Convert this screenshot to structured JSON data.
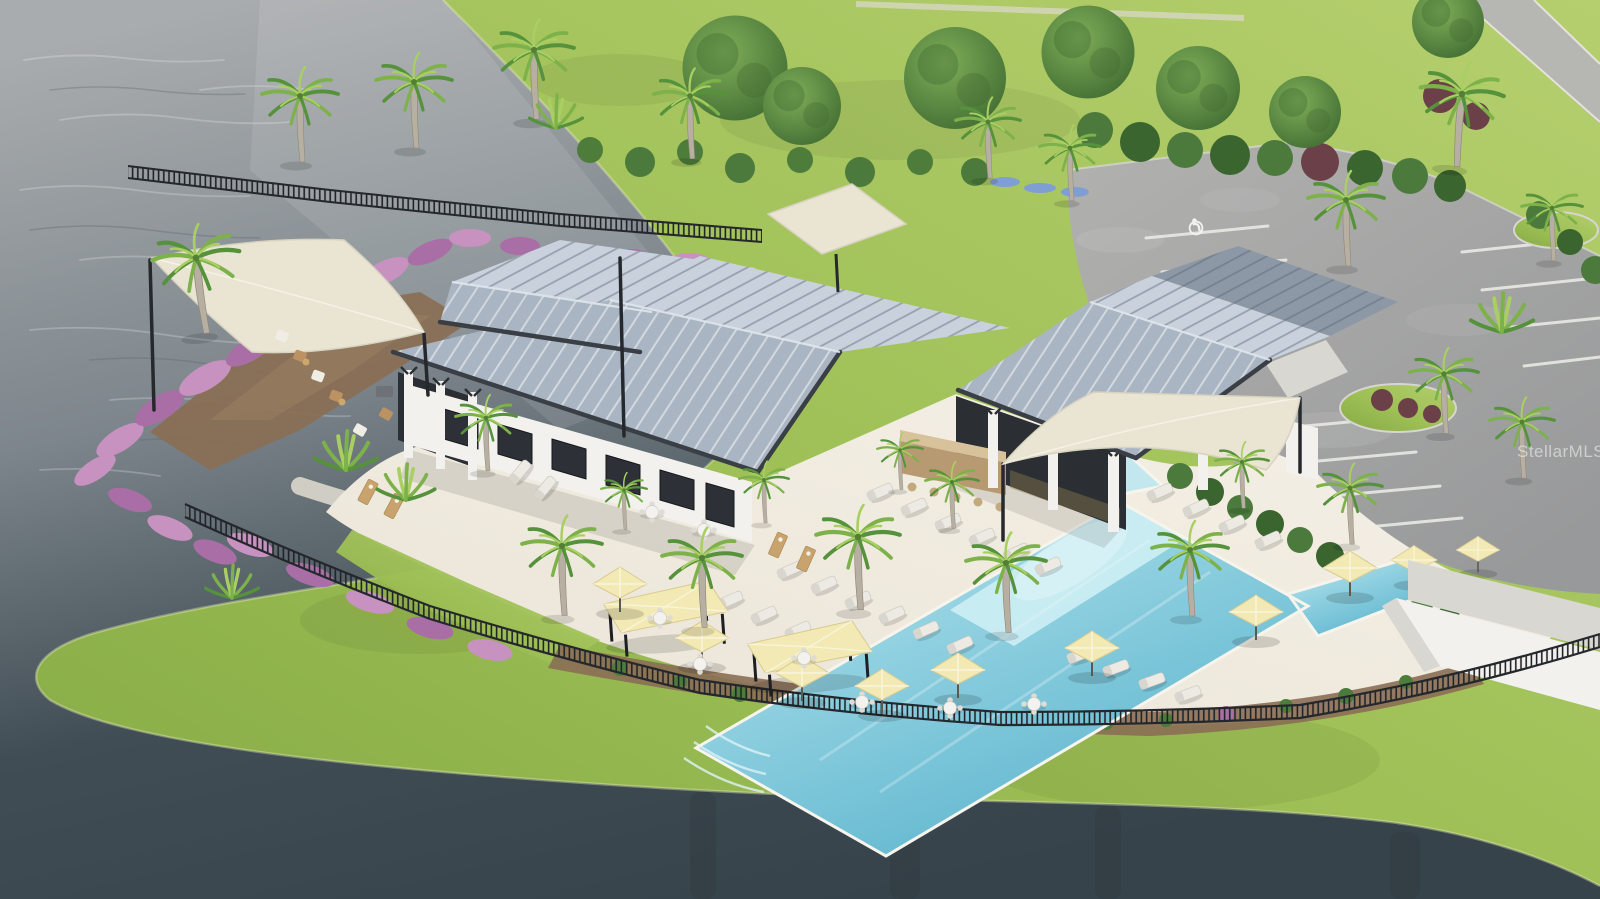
{
  "image": {
    "kind": "aerial architectural rendering",
    "subject": "Lakeside community clubhouse with metal hip roofs, resort pool with yellow umbrellas and cabanas, palm landscaping, black perimeter fence and parking lot"
  },
  "watermark": {
    "text": "StellarMLS"
  },
  "palette": {
    "water_far": "#a9acae",
    "water_mid": "#7d868c",
    "water_near": "#414d55",
    "water_deep": "#37434b",
    "grass": "#9dbf55",
    "grass_light": "#b5cf6e",
    "grass_dark": "#85a945",
    "roof_main": "#aab5c3",
    "roof_light": "#c9d2dc",
    "roof_dark": "#8d98a7",
    "fascia": "#3a3e45",
    "wall": "#f2f1ed",
    "wall_shade": "#d9d7d1",
    "deck": "#ebe5d8",
    "deck_light": "#f5f0e6",
    "path": "#d6d2c8",
    "pool": "#8fd0e0",
    "pool_light": "#c3e7ee",
    "pool_deep": "#5cb4cd",
    "umbrella": "#f2e9b4",
    "umbrella_edge": "#d9cb8e",
    "sail": "#eae4d3",
    "fence": "#24272b",
    "pink": "#c792c0",
    "pink_deep": "#a96ea6",
    "mulch": "#8a6e54",
    "shrub_red": "#6b4048",
    "parking": "#98999a",
    "parking_light": "#b1b1af",
    "stripe": "#e9e9e5",
    "hedge": "#4c7a3c",
    "tree": "#4e7d3b",
    "tree_dark": "#3a652f",
    "palm": "#7db14a",
    "palm_light": "#a9cf63",
    "palm_dark": "#55923b",
    "trunk": "#b7b0a2",
    "road": "#b6b6b2"
  },
  "scene": {
    "regions": [
      "lake",
      "lawn",
      "parking-lot",
      "street",
      "clubhouse",
      "pool",
      "pool-deck",
      "perimeter-fence",
      "shade-sails",
      "gardens"
    ]
  }
}
